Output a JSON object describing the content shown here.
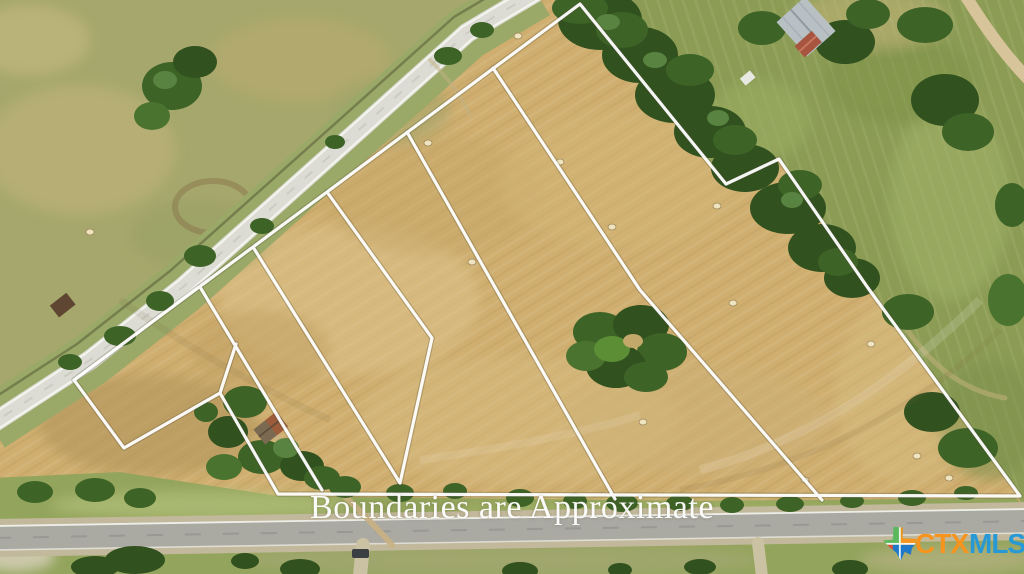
{
  "scene": {
    "type": "aerial-drone-photo-real-estate-listing",
    "watermark": "Boundaries are Approximate",
    "description": "Aerial view of mowed hay acreage divided into lots by white boundary overlay lines, a diagonal highway upper-left, a paved road along the bottom, tree clusters, hay bales, barn at top, small shed in a boundary notch"
  },
  "logo": {
    "ctx": "CTX",
    "mls": "MLS",
    "ctx_color": "#f7941e",
    "mls_color": "#2699d6",
    "texas_icon_colors": [
      "#5cb85c",
      "#f7941e",
      "#1f78c8"
    ]
  },
  "palette": {
    "hay_field": "#cfae6f",
    "hay_light": "#dcc28b",
    "hay_dark": "#b2955c",
    "nw_pasture": "#a6a76c",
    "ne_pasture": "#8c9c55",
    "grass_strip": "#93a45c",
    "tree_dark": "#31511f",
    "tree_mid": "#3e6327",
    "tree_light": "#598340",
    "highway": "#dcdcd4",
    "bottom_road": "#aaa9a2",
    "boundary_line": "#ffffff"
  },
  "objects": [
    "highway-diagonal",
    "bottom-road",
    "boundary-overlay",
    "lot-division-lines",
    "tree-island",
    "shed-in-notch",
    "barn-top",
    "hay-bales",
    "driveways",
    "car"
  ]
}
